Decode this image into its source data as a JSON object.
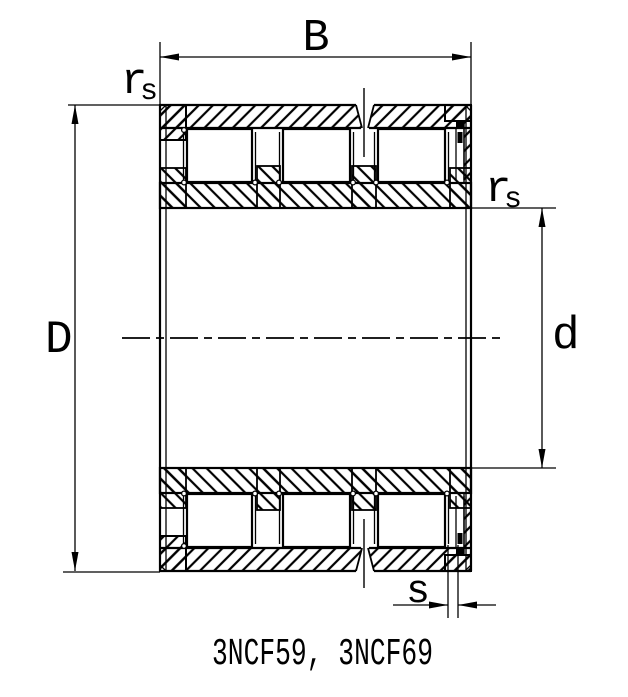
{
  "page": {
    "background_color": "#ffffff",
    "line_color": "#000000"
  },
  "caption": {
    "text": "3NCF59, 3NCF69"
  },
  "dimensions": {
    "width_label": "B",
    "outer_diameter_label": "D",
    "bore_diameter_label": "d",
    "offset_label": "s",
    "fillet_label_left": {
      "base": "r",
      "sub": "s"
    },
    "fillet_label_right": {
      "base": "r",
      "sub": "s"
    }
  }
}
